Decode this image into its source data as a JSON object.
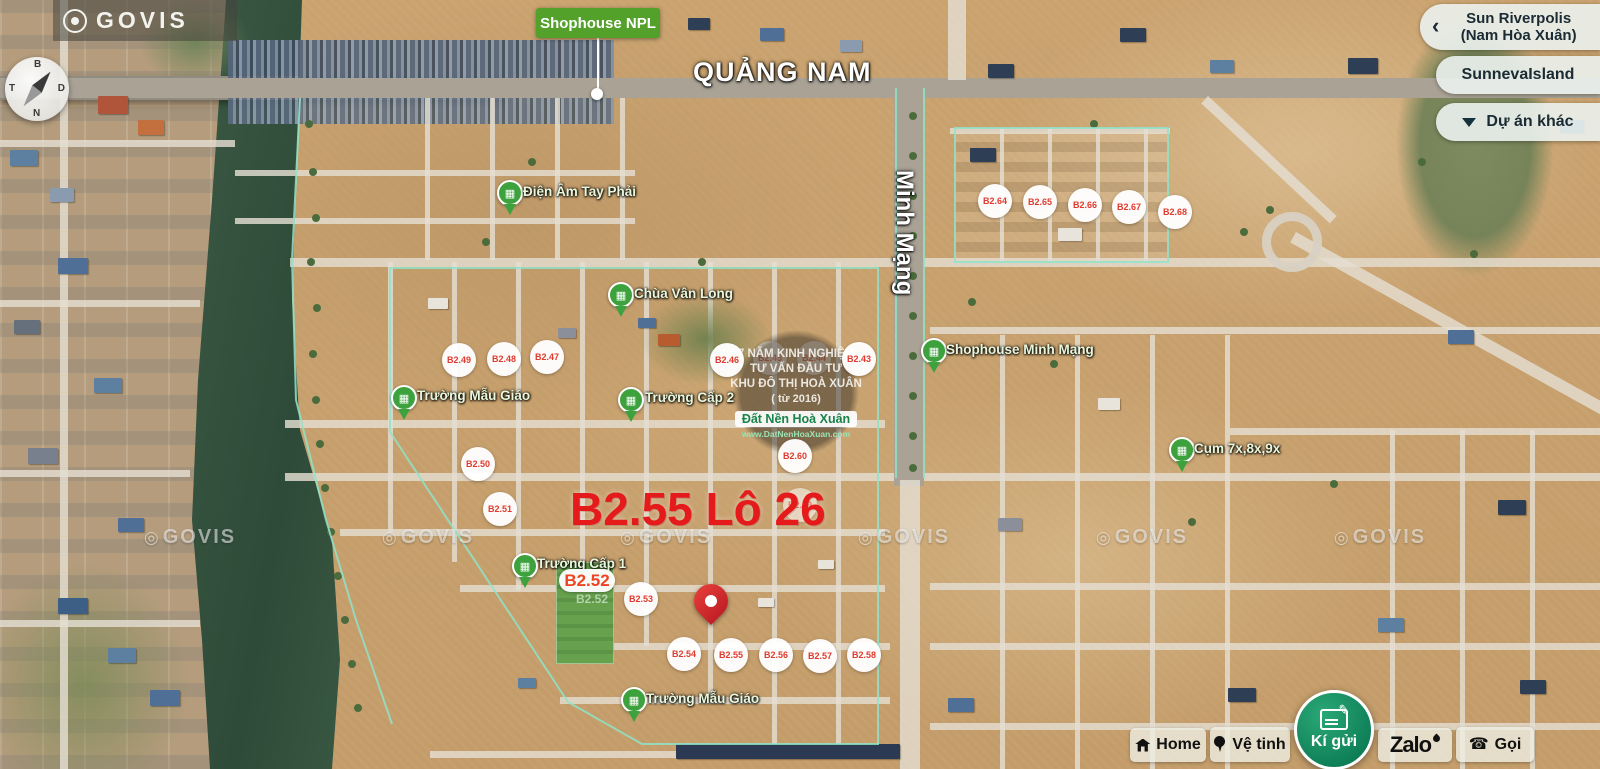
{
  "brand": {
    "logo_text": "GOVIS",
    "watermark_text": "GOVIS"
  },
  "compass": {
    "north": "B",
    "east": "D",
    "south": "N",
    "west": "T"
  },
  "map_flag": {
    "label": "Shophouse NPL"
  },
  "streets": {
    "quang_nam": "QUẢNG NAM",
    "minh_mang": "Minh Mạng"
  },
  "selected_lot": {
    "title": "B2.55 Lô 26"
  },
  "highlight": {
    "label": "B2.52",
    "ghost": "B2.52"
  },
  "watermark_badge": {
    "lines": [
      "7 NĂM KINH NGHIỆM",
      "TƯ VẤN ĐẦU TƯ",
      "KHU ĐÔ THỊ HOÀ XUÂN",
      "( từ 2016)"
    ],
    "brand": "Đất Nền Hoà Xuân",
    "website": "www.DatNenHoaXuan.com"
  },
  "project_panel": {
    "items": [
      {
        "line1": "Sun Riverpolis",
        "line2": "(Nam Hòa Xuân)"
      },
      {
        "line1": "SunnevaIsland",
        "line2": ""
      },
      {
        "line1": "Dự án khác",
        "line2": ""
      }
    ]
  },
  "toolbar": {
    "home": "Home",
    "satellite": "Vệ tinh",
    "consign": "Kí gửi",
    "zalo": "Zalo",
    "call": "Gọi"
  },
  "lot_badges": [
    {
      "label": "B2.43",
      "x": 859,
      "y": 359,
      "faint": false
    },
    {
      "label": "B2.44",
      "x": 814,
      "y": 358,
      "faint": true
    },
    {
      "label": "B2.45",
      "x": 770,
      "y": 358,
      "faint": true
    },
    {
      "label": "B2.46",
      "x": 727,
      "y": 360,
      "faint": false
    },
    {
      "label": "B2.47",
      "x": 547,
      "y": 357,
      "faint": false
    },
    {
      "label": "B2.48",
      "x": 504,
      "y": 359,
      "faint": false
    },
    {
      "label": "B2.49",
      "x": 459,
      "y": 360,
      "faint": false
    },
    {
      "label": "B2.50",
      "x": 478,
      "y": 464,
      "faint": false
    },
    {
      "label": "B2.51",
      "x": 500,
      "y": 509,
      "faint": false
    },
    {
      "label": "B2.53",
      "x": 641,
      "y": 599,
      "faint": false
    },
    {
      "label": "B2.54",
      "x": 684,
      "y": 654,
      "faint": false
    },
    {
      "label": "B2.55",
      "x": 731,
      "y": 655,
      "faint": false
    },
    {
      "label": "B2.56",
      "x": 776,
      "y": 655,
      "faint": false
    },
    {
      "label": "B2.57",
      "x": 820,
      "y": 656,
      "faint": false
    },
    {
      "label": "B2.58",
      "x": 864,
      "y": 655,
      "faint": false
    },
    {
      "label": "B2.59",
      "x": 800,
      "y": 505,
      "faint": true
    },
    {
      "label": "B2.60",
      "x": 795,
      "y": 456,
      "faint": false
    },
    {
      "label": "B2.64",
      "x": 995,
      "y": 201,
      "faint": false
    },
    {
      "label": "B2.65",
      "x": 1040,
      "y": 202,
      "faint": false
    },
    {
      "label": "B2.66",
      "x": 1085,
      "y": 205,
      "faint": false
    },
    {
      "label": "B2.67",
      "x": 1129,
      "y": 207,
      "faint": false
    },
    {
      "label": "B2.68",
      "x": 1175,
      "y": 212,
      "faint": false
    }
  ],
  "poi_markers": [
    {
      "id": "dien-am-tay-phai",
      "label": "Điện Âm Tay Phải",
      "pin_x": 497,
      "pin_y": 180,
      "text_x": 523,
      "text_y": 184
    },
    {
      "id": "chua-van-long",
      "label": "Chùa Vân Long",
      "pin_x": 608,
      "pin_y": 282,
      "text_x": 634,
      "text_y": 286
    },
    {
      "id": "truong-mau-giao-tay",
      "label": "Trường Mẫu Giáo",
      "pin_x": 391,
      "pin_y": 385,
      "text_x": 417,
      "text_y": 388
    },
    {
      "id": "truong-cap-2",
      "label": "Trường Cấp 2",
      "pin_x": 618,
      "pin_y": 387,
      "text_x": 645,
      "text_y": 390
    },
    {
      "id": "shophouse-minh-mang",
      "label": "Shophouse Minh Mạng",
      "pin_x": 921,
      "pin_y": 338,
      "text_x": 946,
      "text_y": 342
    },
    {
      "id": "cum-7x-8x-9x",
      "label": "Cụm 7x,8x,9x",
      "pin_x": 1169,
      "pin_y": 437,
      "text_x": 1194,
      "text_y": 441
    },
    {
      "id": "truong-cap-1",
      "label": "Trường Cấp 1",
      "pin_x": 512,
      "pin_y": 553,
      "text_x": 537,
      "text_y": 556
    },
    {
      "id": "truong-mau-giao-nam",
      "label": "Trường Mẫu Giáo",
      "pin_x": 621,
      "pin_y": 687,
      "text_x": 646,
      "text_y": 691
    }
  ],
  "watermark_row": {
    "y": 526,
    "x_centers": [
      190,
      428,
      666,
      904,
      1142,
      1380
    ]
  },
  "colors": {
    "accent_green": "#3da23d",
    "badge_red": "#e03a2e",
    "title_red": "#e51b1b",
    "flag_green": "#53a12b",
    "consign_green": "#0e7e57",
    "boundary_teal": "#8fe3c9"
  }
}
